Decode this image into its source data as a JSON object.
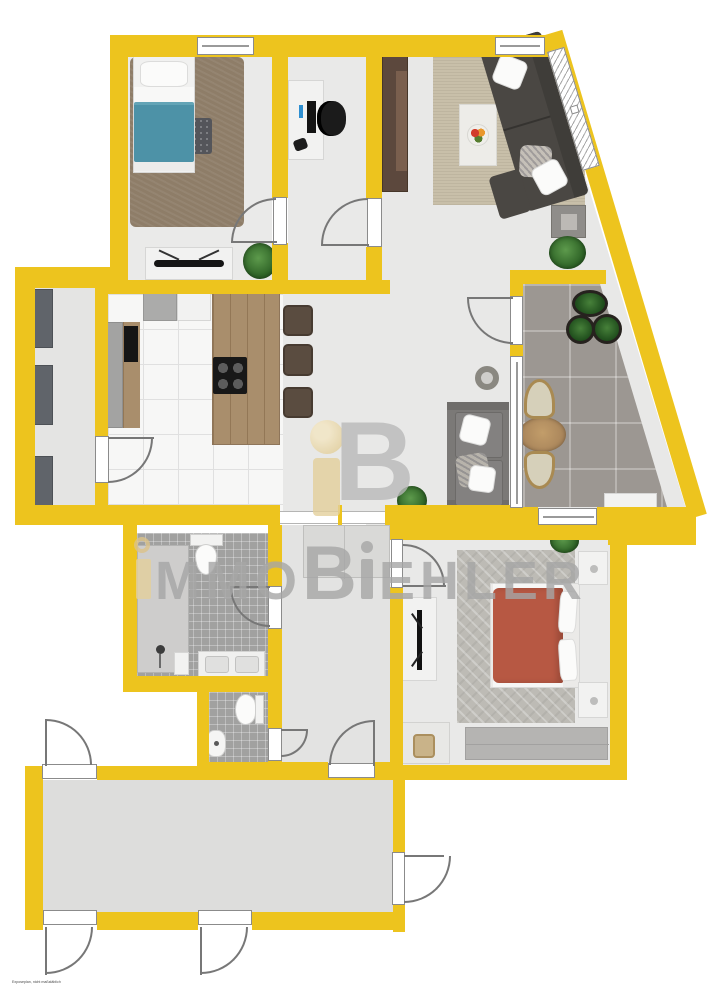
{
  "brand": {
    "logo_letter_b": "B",
    "name_i1": "i",
    "name_part1": "MMO",
    "name_b": "B",
    "name_i2": "i",
    "name_part2": "EHLER",
    "full_name": "iMMOBiEHLER"
  },
  "disclaimer": "Exposeplan, nicht maßstäblich",
  "colors": {
    "wall_yellow": "#edc41e",
    "floor_gray": "#e8e8e7",
    "balcony_tile": "#9c9792",
    "bathroom_mosaic": "#a1a1a0",
    "wood": "#a98e6c",
    "bed_teal": "#4d92a7",
    "bed_terracotta": "#b75843",
    "sofa_dark": "#4a4743",
    "brand_tan": "#e4d09c",
    "brand_gray": "#a6a6a6"
  },
  "rooms": [
    {
      "id": "bedroom-top-left",
      "furniture": [
        "single-bed-teal",
        "shag-carpet",
        "dark-rug",
        "tv-sideboard",
        "plant"
      ]
    },
    {
      "id": "office",
      "furniture": [
        "desk",
        "monitor",
        "office-chair"
      ]
    },
    {
      "id": "living-room",
      "furniture": [
        "wardrobe",
        "area-rug",
        "corner-sofa",
        "coffee-rug",
        "fruit-bowl",
        "side-table",
        "plant"
      ]
    },
    {
      "id": "kitchen",
      "furniture": [
        "fridge",
        "counter",
        "island-with-cooktop",
        "bar-chairs"
      ]
    },
    {
      "id": "storage-hall",
      "furniture": [
        "cabinet",
        "cabinet",
        "cabinet"
      ]
    },
    {
      "id": "lounge-area",
      "furniture": [
        "sofa",
        "round-side-table",
        "plant"
      ]
    },
    {
      "id": "balcony",
      "furniture": [
        "plant-pots",
        "round-table",
        "wicker-chairs",
        "bench"
      ]
    },
    {
      "id": "corridor",
      "furniture": [
        "built-in-closet"
      ]
    },
    {
      "id": "bathroom",
      "furniture": [
        "shower",
        "toilet",
        "double-vanity"
      ]
    },
    {
      "id": "wc",
      "furniture": [
        "toilet",
        "hand-sink"
      ]
    },
    {
      "id": "bedroom-bottom-right",
      "furniture": [
        "double-bed-terracotta",
        "herringbone-rug",
        "nightstands",
        "tv-board",
        "wardrobe",
        "desk",
        "plant"
      ]
    },
    {
      "id": "terrace",
      "furniture": []
    }
  ]
}
